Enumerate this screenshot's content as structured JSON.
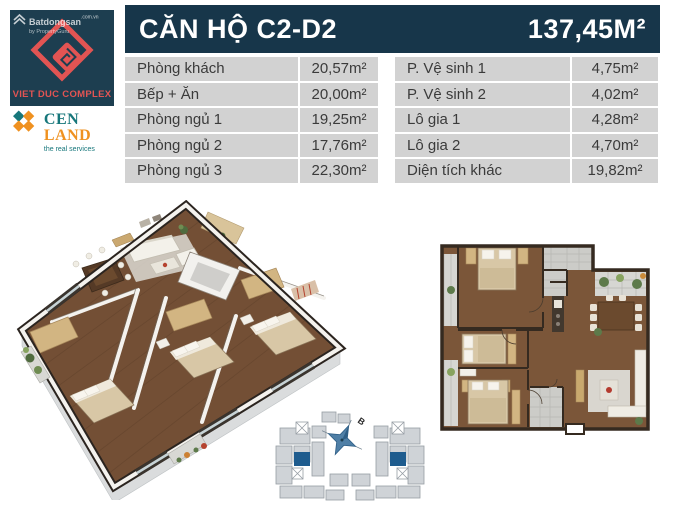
{
  "branding": {
    "watermark": {
      "brand": "Batdongsan",
      "suffix": ".com.vn",
      "byline": "by PropertyGuru"
    },
    "vietduc": {
      "name": "VIET DUC COMPLEX"
    },
    "cenland": {
      "cen": "CEN",
      "land": "LAND",
      "tagline": "the real services"
    }
  },
  "header": {
    "title": "CĂN HỘ C2-D2",
    "area": "137,45M²"
  },
  "rooms": {
    "left": [
      {
        "label": "Phòng khách",
        "value": "20,57m²"
      },
      {
        "label": "Bếp + Ăn",
        "value": "20,00m²"
      },
      {
        "label": "Phòng ngủ 1",
        "value": "19,25m²"
      },
      {
        "label": "Phòng ngủ 2",
        "value": "17,76m²"
      },
      {
        "label": "Phòng ngủ 3",
        "value": "22,30m²"
      }
    ],
    "right": [
      {
        "label": "P. Vệ sinh 1",
        "value": "4,75m²"
      },
      {
        "label": "P. Vệ sinh 2",
        "value": "4,02m²"
      },
      {
        "label": "Lô gia 1",
        "value": "4,28m²"
      },
      {
        "label": "Lô gia 2",
        "value": "4,70m²"
      },
      {
        "label": "Diện tích khác",
        "value": "19,82m²"
      }
    ]
  },
  "siteplan": {
    "compass_label": "B"
  },
  "colors": {
    "header_navy": "#17364a",
    "table_gray": "#d2d2d2",
    "text_dark": "#3b3b3b",
    "brand_red": "#e25453",
    "vietduc_bg": "#1d3e50",
    "cen_teal": "#17777b",
    "cen_orange": "#ef9120",
    "unit_highlight_blue": "#1e5c8e",
    "wood_floor": "#734f35"
  }
}
